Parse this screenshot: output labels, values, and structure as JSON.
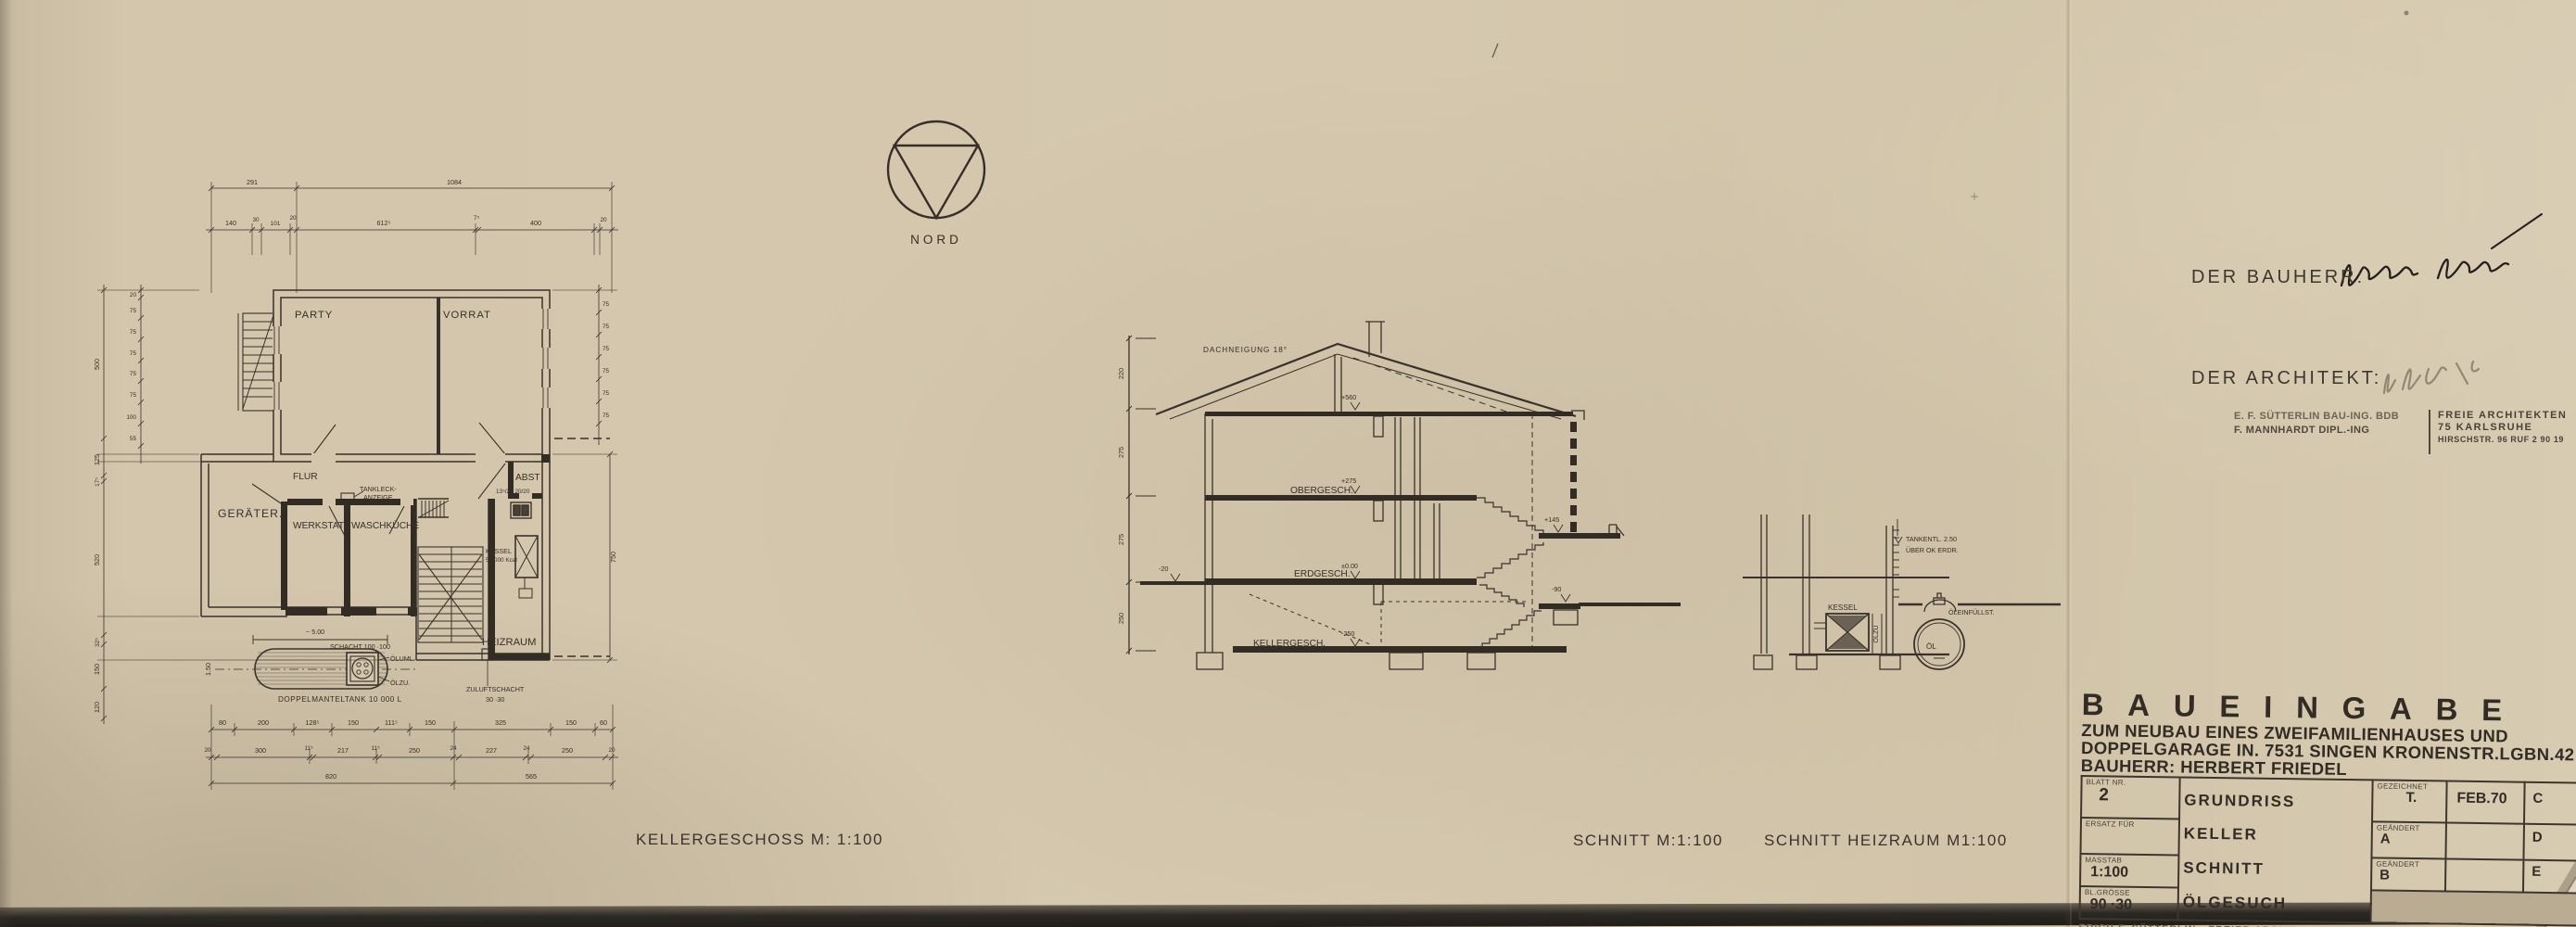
{
  "nord": {
    "label": "NORD"
  },
  "captions": {
    "plan": "KELLERGESCHOSS   M: 1:100",
    "schnitt": "SCHNITT   M:1:100",
    "heiz": "SCHNITT  HEIZRAUM  M1:100"
  },
  "plan": {
    "rooms": {
      "party": "PARTY",
      "vorrat": "VORRAT",
      "flur": "FLUR",
      "abst": "ABST",
      "geraete": "GERÄTER.",
      "werkstatt": "WERKSTATT",
      "waschkueche": "WASCHKÜCHE",
      "heizraum": "HEIZRAUM"
    },
    "labels": {
      "tankleck1": "TANKLECK-",
      "tankleck2": "ANZEIGE",
      "kessel": "KESSEL",
      "kcal": "50 000 Kcal",
      "schacht": "SCHACHT 100 ·100",
      "oeluml": "ÖLUML.",
      "oelzu": "ÖLZU.",
      "tank": "DOPPELMANTELTANK  10 000 L",
      "zuluft1": "ZULUFTSCHACHT",
      "zuluft2": "30 ·30",
      "approx": "~ 5.00",
      "tankheight": "1.50",
      "abstdims": "13⁵/20  20/20"
    },
    "dims": {
      "top1": [
        "291",
        "1084"
      ],
      "top2": [
        "140",
        "30",
        "101",
        "20",
        "612⁵",
        "7⁵",
        "400",
        "20"
      ],
      "b1": [
        "80",
        "200",
        "128⁵",
        "150",
        "111⁵",
        "150",
        "325",
        "150",
        "60"
      ],
      "b2": [
        "20",
        "300",
        "11⁵",
        "217",
        "11⁵",
        "250",
        "24",
        "227",
        "24",
        "250",
        "20"
      ],
      "b3": [
        "820",
        "565"
      ],
      "leftSmall": [
        "20",
        "75",
        "75",
        "75",
        "75",
        "75",
        "100",
        "55"
      ],
      "leftBig": [
        "500",
        "125",
        "17⁵",
        "520",
        "32⁵",
        "150",
        "120"
      ],
      "rightSmall": [
        "75",
        "75",
        "75",
        "75",
        "75",
        "75"
      ],
      "rightBig": [
        "750"
      ]
    }
  },
  "section": {
    "roof": "DACHNEIGUNG 18°",
    "floors": [
      "OBERGESCH.",
      "ERDGESCH.",
      "KELLERGESCH."
    ],
    "levels": {
      "ridge": "+560",
      "og": "+275",
      "eg": "±0.00",
      "kg": "-250",
      "terrain": "-20",
      "landingUp": "+145",
      "landingLow": "-90"
    },
    "dims": [
      "220",
      "275",
      "275",
      "250"
    ]
  },
  "heiz": {
    "tankentl1": "TANKENTL. 2.50",
    "tankentl2": "ÜBER OK ERDR.",
    "kessel": "KESSEL",
    "oelzu": "ÖLZU",
    "oelfuell": "ÖLEINFÜLLST.",
    "oel": "ÖL"
  },
  "right": {
    "bauherr": "DER BAUHERR:",
    "architekt": "DER ARCHITEKT:"
  },
  "stamp": {
    "l1": "E. F. SÜTTERLIN   BAU-ING. BDB",
    "l2": "F. MANNHARDT   DIPL.-ING",
    "r1": "FREIE ARCHITEKTEN",
    "r2": "75 KARLSRUHE",
    "r3": "HIRSCHSTR. 96  RUF 2 90 19"
  },
  "tb": {
    "title": "BAUEINGABE",
    "sub1": "ZUM NEUBAU EINES ZWEIFAMILIENHAUSES UND",
    "sub2": "DOPPELGARAGE IN. 7531 SINGEN KRONENSTR.LGBN.42",
    "sub3": "BAUHERR: HERBERT FRIEDEL",
    "blatt_label": "BLATT NR.",
    "blatt": "2",
    "ersatz_label": "ERSATZ FÜR",
    "masstab_label": "MASSTAB",
    "masstab": "1:100",
    "groesse_label": "BL.GRÖSSE",
    "groesse": "90 ·30",
    "mid": [
      "GRUNDRISS KELLER",
      "SCHNITT",
      "ÖLGESUCH"
    ],
    "gez_label": "GEZEICHNET",
    "gez": "T.",
    "date": "FEB.70",
    "geae_label": "GEÄNDERT",
    "a": "A",
    "b": "B",
    "c": "C",
    "d": "D",
    "e": "E",
    "footer": "ERICH F. SÜTTERLIN  ·  FREIER ARCHITEKT  ·  KARLSRUHE  ·  HIRSCHSTR. 96  ·  TELEFON 2"
  }
}
